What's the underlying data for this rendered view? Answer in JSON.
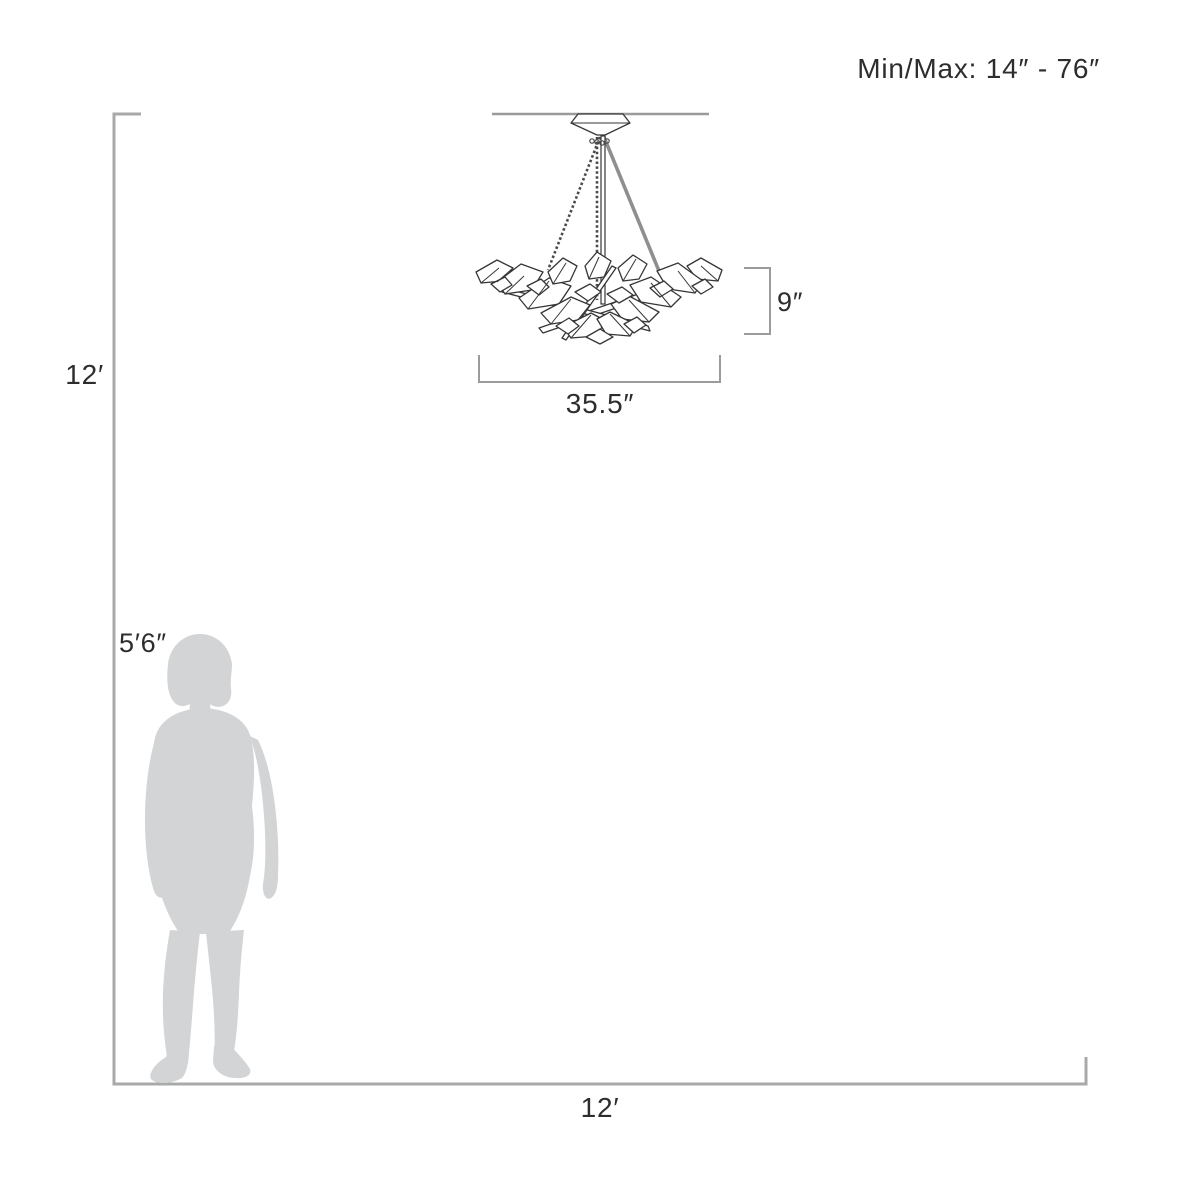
{
  "labels": {
    "min_max": "Min/Max: 14″ - 76″",
    "fixture_height": "9″",
    "fixture_width": "35.5″",
    "room_height": "12′",
    "room_width": "12′",
    "person_height": "5′6″"
  },
  "diagram": {
    "subject": "crystal-chandelier-pendant",
    "room_size": "12′ × 12′",
    "person_reference_height": "5′6″",
    "fixture_body_height": "9″",
    "fixture_body_width": "35.5″",
    "suspension_min_max": "14″ - 76″"
  },
  "colors": {
    "background": "#ffffff",
    "text": "#2d2d2d",
    "line_art": "#363636",
    "outline_gray": "#a8aaa9",
    "dimension_gray": "#9b9b9b",
    "chain_gray": "#8f8f8f",
    "silhouette_gray": "#d2d4d5"
  }
}
